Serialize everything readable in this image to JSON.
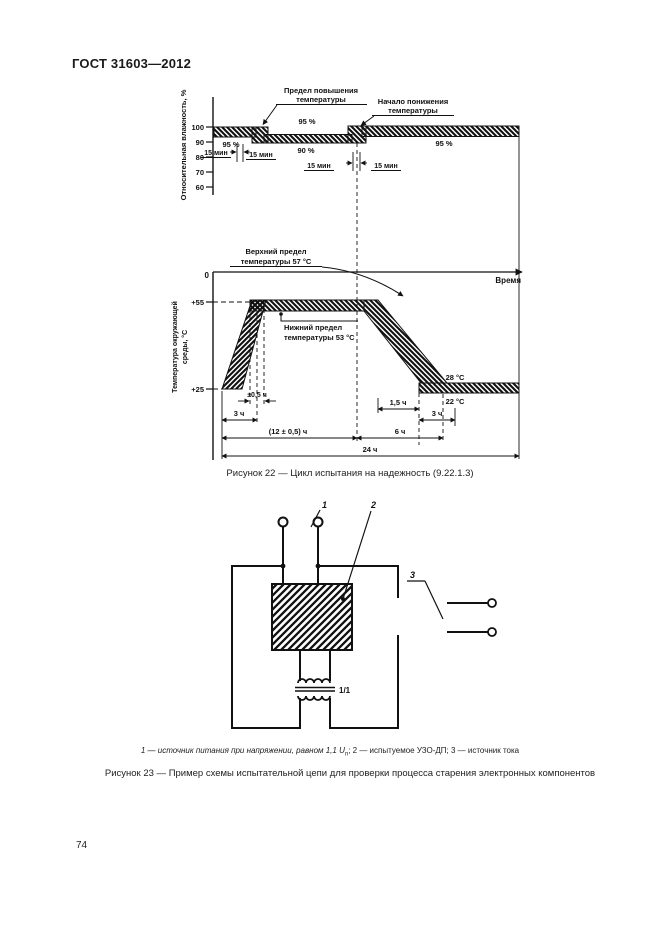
{
  "page": {
    "header": "ГОСТ 31603—2012",
    "page_number": "74"
  },
  "fig22": {
    "caption": "Рисунок 22 — Цикл испытания на надежность (9.22.1.3)",
    "humidity": {
      "axis_label": "Относительная влажность, %",
      "tick_100": "100",
      "tick_90": "90",
      "tick_80": "80",
      "tick_70": "70",
      "tick_60": "60",
      "band_left_label": "95 %",
      "band_mid_top_label": "95 %",
      "band_mid_bottom_label": "90 %",
      "band_right_label": "95 %",
      "t1": "15 мин",
      "t2": "15 мин",
      "t3": "15 мин",
      "t4": "15 мин",
      "ann_rise_line1": "Предел повышения",
      "ann_rise_line2": "температуры",
      "ann_fall_line1": "Начало понижения",
      "ann_fall_line2": "температуры"
    },
    "time_axis": {
      "origin": "0",
      "label": "Время"
    },
    "temperature": {
      "axis_label_line1": "Температура окружающей",
      "axis_label_line2": "среды, °C",
      "tick_55": "+55",
      "tick_25": "+25",
      "upper_limit_line1": "Верхний предел",
      "upper_limit_line2": "температуры 57 °C",
      "lower_limit_line1": "Нижний предел",
      "lower_limit_line2": "температуры 53 °C",
      "label_28": "28 °C",
      "label_22": "22 °C"
    },
    "dims": {
      "d_3h_left": "3 ч",
      "d_05h": "±0,5 ч",
      "d_15h": "1,5 ч",
      "d_3h_right": "3 ч",
      "d_12h": "(12 ± 0,5) ч",
      "d_6h": "6 ч",
      "d_24h": "24 ч"
    }
  },
  "fig23": {
    "caption": "Рисунок 23 — Пример схемы испытательной цепи для проверки процесса старения электронных компонентов",
    "labels": {
      "l1": "1",
      "l2": "2",
      "l3": "3",
      "ratio": "1/1"
    },
    "footnote": {
      "p1": "1 — источник питания при напряжении, равном 1,1 ",
      "u": "U",
      "sub": "n",
      "p2": "; 2 — испытуемое УЗО-ДП; 3 — источник тока"
    }
  }
}
